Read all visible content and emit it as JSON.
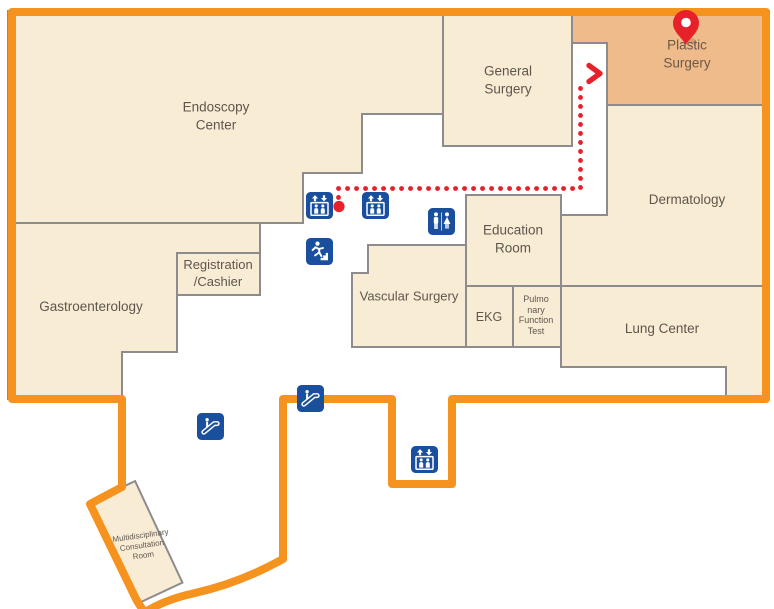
{
  "map": {
    "title": "hospital-floor-map",
    "rooms": {
      "endoscopy_center": {
        "label": "Endoscopy\nCenter"
      },
      "general_surgery": {
        "label": "General\nSurgery"
      },
      "plastic_surgery": {
        "label": "Plastic Surgery",
        "highlighted": true
      },
      "dermatology": {
        "label": "Dermatology"
      },
      "gastroenterology": {
        "label": "Gastroenterology"
      },
      "registration_cashier": {
        "label": "Registration\n/Cashier"
      },
      "education_room": {
        "label": "Education\nRoom"
      },
      "vascular_surgery": {
        "label": "Vascular Surgery"
      },
      "ekg": {
        "label": "EKG"
      },
      "pulmonary_function_test": {
        "label": "Pulmo\nnary\nFunction\nTest"
      },
      "lung_center": {
        "label": "Lung Center"
      },
      "multidisciplinary_consultation_room": {
        "label": "Multidisciplinary\nConsultation\nRoom"
      }
    },
    "route": {
      "pattern": "dotted",
      "color": "#E6212A",
      "destination": "Plastic Surgery"
    },
    "icons": {
      "elevator": {
        "name": "elevator-icon",
        "count": 3
      },
      "restroom": {
        "name": "restroom-icon",
        "count": 1
      },
      "emergency_exit": {
        "name": "emergency-exit-icon",
        "count": 1
      },
      "escalator": {
        "name": "escalator-icon",
        "count": 2
      },
      "destination_pin": {
        "name": "location-pin-icon",
        "count": 1
      }
    },
    "colors": {
      "outline_orange": "#F6921E",
      "room_fill": "#F9ECD5",
      "highlight_fill": "#F0BB8B",
      "border_gray": "#8C8C8C",
      "label_text": "#5E564D",
      "icon_blue": "#1A4F9E",
      "route_red": "#E6212A"
    }
  }
}
